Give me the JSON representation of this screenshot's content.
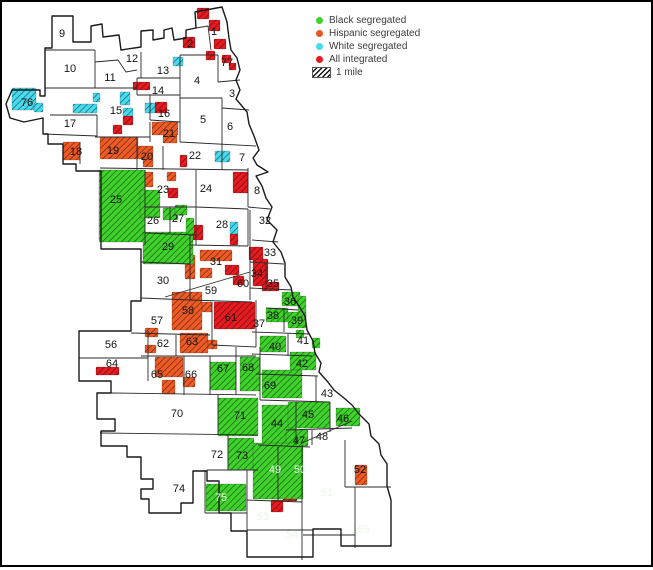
{
  "title": "Chicago community areas segregation map",
  "legend": {
    "items": [
      {
        "label": "Black segregated",
        "color": "#3ed32a",
        "swatch": "dot"
      },
      {
        "label": "Hispanic segregated",
        "color": "#ee5426",
        "swatch": "dot"
      },
      {
        "label": "White segregated",
        "color": "#45dcef",
        "swatch": "dot"
      },
      {
        "label": "All integrated",
        "color": "#e8191f",
        "swatch": "dot"
      },
      {
        "label": "1 mile",
        "color": "#111111",
        "swatch": "hatch"
      }
    ]
  },
  "map": {
    "colors": {
      "green": "#3ed32a",
      "orange": "#f15a24",
      "cyan": "#45dcef",
      "red": "#e8191f",
      "darkred": "#9e1115",
      "white": "#ffffff",
      "boundary": "#2a2a2a"
    },
    "areas": [
      {
        "n": "1",
        "x": 214,
        "y": 31
      },
      {
        "n": "2",
        "x": 190,
        "y": 43
      },
      {
        "n": "3",
        "x": 232,
        "y": 93
      },
      {
        "n": "4",
        "x": 197,
        "y": 80
      },
      {
        "n": "5",
        "x": 203,
        "y": 119
      },
      {
        "n": "6",
        "x": 230,
        "y": 126
      },
      {
        "n": "7",
        "x": 242,
        "y": 157
      },
      {
        "n": "8",
        "x": 257,
        "y": 190
      },
      {
        "n": "9",
        "x": 62,
        "y": 33
      },
      {
        "n": "10",
        "x": 70,
        "y": 68
      },
      {
        "n": "11",
        "x": 110,
        "y": 77
      },
      {
        "n": "12",
        "x": 132,
        "y": 58
      },
      {
        "n": "13",
        "x": 163,
        "y": 70
      },
      {
        "n": "14",
        "x": 158,
        "y": 90
      },
      {
        "n": "15",
        "x": 116,
        "y": 110
      },
      {
        "n": "16",
        "x": 164,
        "y": 113
      },
      {
        "n": "17",
        "x": 70,
        "y": 123
      },
      {
        "n": "18",
        "x": 76,
        "y": 151
      },
      {
        "n": "19",
        "x": 113,
        "y": 150
      },
      {
        "n": "20",
        "x": 147,
        "y": 156
      },
      {
        "n": "21",
        "x": 169,
        "y": 133
      },
      {
        "n": "22",
        "x": 195,
        "y": 155
      },
      {
        "n": "23",
        "x": 163,
        "y": 189
      },
      {
        "n": "24",
        "x": 206,
        "y": 188
      },
      {
        "n": "25",
        "x": 116,
        "y": 199
      },
      {
        "n": "26",
        "x": 153,
        "y": 220
      },
      {
        "n": "27",
        "x": 178,
        "y": 218
      },
      {
        "n": "28",
        "x": 222,
        "y": 224
      },
      {
        "n": "29",
        "x": 168,
        "y": 246
      },
      {
        "n": "30",
        "x": 163,
        "y": 280
      },
      {
        "n": "31",
        "x": 216,
        "y": 261
      },
      {
        "n": "32",
        "x": 265,
        "y": 220
      },
      {
        "n": "33",
        "x": 270,
        "y": 252
      },
      {
        "n": "34",
        "x": 257,
        "y": 273
      },
      {
        "n": "35",
        "x": 273,
        "y": 283
      },
      {
        "n": "36",
        "x": 290,
        "y": 301
      },
      {
        "n": "37",
        "x": 259,
        "y": 323
      },
      {
        "n": "38",
        "x": 273,
        "y": 315
      },
      {
        "n": "39",
        "x": 297,
        "y": 320
      },
      {
        "n": "40",
        "x": 275,
        "y": 346
      },
      {
        "n": "41",
        "x": 303,
        "y": 340
      },
      {
        "n": "42",
        "x": 302,
        "y": 363
      },
      {
        "n": "43",
        "x": 327,
        "y": 393
      },
      {
        "n": "44",
        "x": 277,
        "y": 423
      },
      {
        "n": "45",
        "x": 308,
        "y": 414
      },
      {
        "n": "46",
        "x": 343,
        "y": 418
      },
      {
        "n": "47",
        "x": 299,
        "y": 440
      },
      {
        "n": "48",
        "x": 322,
        "y": 436
      },
      {
        "n": "49",
        "x": 275,
        "y": 469,
        "light": true
      },
      {
        "n": "50",
        "x": 300,
        "y": 469,
        "light": true
      },
      {
        "n": "51",
        "x": 327,
        "y": 492,
        "light": true
      },
      {
        "n": "52",
        "x": 360,
        "y": 469
      },
      {
        "n": "53",
        "x": 263,
        "y": 516,
        "light": true
      },
      {
        "n": "54",
        "x": 292,
        "y": 534,
        "light": true
      },
      {
        "n": "55",
        "x": 364,
        "y": 529,
        "light": true
      },
      {
        "n": "56",
        "x": 111,
        "y": 344
      },
      {
        "n": "57",
        "x": 157,
        "y": 320
      },
      {
        "n": "58",
        "x": 188,
        "y": 310
      },
      {
        "n": "59",
        "x": 211,
        "y": 290
      },
      {
        "n": "60",
        "x": 243,
        "y": 283
      },
      {
        "n": "61",
        "x": 231,
        "y": 317
      },
      {
        "n": "62",
        "x": 163,
        "y": 343
      },
      {
        "n": "63",
        "x": 192,
        "y": 341
      },
      {
        "n": "64",
        "x": 112,
        "y": 363
      },
      {
        "n": "65",
        "x": 157,
        "y": 374
      },
      {
        "n": "66",
        "x": 191,
        "y": 374
      },
      {
        "n": "67",
        "x": 223,
        "y": 368
      },
      {
        "n": "68",
        "x": 248,
        "y": 367
      },
      {
        "n": "69",
        "x": 270,
        "y": 385
      },
      {
        "n": "70",
        "x": 177,
        "y": 413
      },
      {
        "n": "71",
        "x": 240,
        "y": 415
      },
      {
        "n": "72",
        "x": 217,
        "y": 454
      },
      {
        "n": "73",
        "x": 242,
        "y": 455
      },
      {
        "n": "74",
        "x": 179,
        "y": 488
      },
      {
        "n": "75",
        "x": 221,
        "y": 497,
        "light": true
      },
      {
        "n": "76",
        "x": 27,
        "y": 102
      },
      {
        "n": "77",
        "x": 227,
        "y": 62
      }
    ],
    "patches": [
      {
        "x": 197,
        "y": 8,
        "w": 12,
        "h": 11,
        "c": "red"
      },
      {
        "x": 209,
        "y": 20,
        "w": 11,
        "h": 11,
        "c": "red"
      },
      {
        "x": 183,
        "y": 37,
        "w": 12,
        "h": 11,
        "c": "red"
      },
      {
        "x": 214,
        "y": 39,
        "w": 12,
        "h": 10,
        "c": "red"
      },
      {
        "x": 206,
        "y": 51,
        "w": 9,
        "h": 9,
        "c": "red"
      },
      {
        "x": 222,
        "y": 55,
        "w": 9,
        "h": 8,
        "c": "red"
      },
      {
        "x": 229,
        "y": 63,
        "w": 7,
        "h": 7,
        "c": "red"
      },
      {
        "x": 133,
        "y": 82,
        "w": 17,
        "h": 8,
        "c": "red"
      },
      {
        "x": 155,
        "y": 102,
        "w": 12,
        "h": 11,
        "c": "red"
      },
      {
        "x": 123,
        "y": 116,
        "w": 10,
        "h": 9,
        "c": "red"
      },
      {
        "x": 113,
        "y": 125,
        "w": 9,
        "h": 9,
        "c": "red"
      },
      {
        "x": 180,
        "y": 155,
        "w": 7,
        "h": 12,
        "c": "red"
      },
      {
        "x": 168,
        "y": 188,
        "w": 10,
        "h": 10,
        "c": "red"
      },
      {
        "x": 233,
        "y": 172,
        "w": 15,
        "h": 21,
        "c": "red"
      },
      {
        "x": 193,
        "y": 225,
        "w": 10,
        "h": 15,
        "c": "red"
      },
      {
        "x": 230,
        "y": 234,
        "w": 8,
        "h": 11,
        "c": "red"
      },
      {
        "x": 249,
        "y": 247,
        "w": 14,
        "h": 13,
        "c": "red"
      },
      {
        "x": 253,
        "y": 259,
        "w": 15,
        "h": 27,
        "c": "red"
      },
      {
        "x": 225,
        "y": 265,
        "w": 14,
        "h": 10,
        "c": "red"
      },
      {
        "x": 233,
        "y": 276,
        "w": 11,
        "h": 9,
        "c": "red"
      },
      {
        "x": 262,
        "y": 282,
        "w": 17,
        "h": 9,
        "c": "red"
      },
      {
        "x": 214,
        "y": 302,
        "w": 41,
        "h": 27,
        "c": "red"
      },
      {
        "x": 296,
        "y": 357,
        "w": 7,
        "h": 8,
        "c": "red"
      },
      {
        "x": 96,
        "y": 367,
        "w": 23,
        "h": 8,
        "c": "red"
      },
      {
        "x": 283,
        "y": 487,
        "w": 14,
        "h": 14,
        "c": "red"
      },
      {
        "x": 271,
        "y": 500,
        "w": 12,
        "h": 12,
        "c": "red"
      },
      {
        "x": 12,
        "y": 88,
        "w": 24,
        "h": 22,
        "c": "cyan"
      },
      {
        "x": 34,
        "y": 103,
        "w": 9,
        "h": 9,
        "c": "cyan"
      },
      {
        "x": 153,
        "y": 50,
        "w": 20,
        "h": true,
        "c": "cyan"
      },
      {
        "x": 173,
        "y": 57,
        "w": 10,
        "h": 9,
        "c": "cyan"
      },
      {
        "x": 120,
        "y": 92,
        "w": 10,
        "h": 13,
        "c": "cyan"
      },
      {
        "x": 93,
        "y": 93,
        "w": 7,
        "h": 9,
        "c": "cyan"
      },
      {
        "x": 123,
        "y": 108,
        "w": 10,
        "h": 8,
        "c": "cyan"
      },
      {
        "x": 145,
        "y": 103,
        "w": 10,
        "h": 10,
        "c": "cyan"
      },
      {
        "x": 73,
        "y": 104,
        "w": 24,
        "h": 9,
        "c": "cyan"
      },
      {
        "x": 215,
        "y": 151,
        "w": 15,
        "h": 11,
        "c": "cyan"
      },
      {
        "x": 230,
        "y": 222,
        "w": 8,
        "h": 12,
        "c": "cyan"
      },
      {
        "x": 63,
        "y": 142,
        "w": 17,
        "h": 18,
        "c": "orange"
      },
      {
        "x": 100,
        "y": 137,
        "w": 38,
        "h": 22,
        "c": "orange"
      },
      {
        "x": 138,
        "y": 146,
        "w": 15,
        "h": 13,
        "c": "orange"
      },
      {
        "x": 152,
        "y": 122,
        "w": 26,
        "h": 13,
        "c": "orange"
      },
      {
        "x": 163,
        "y": 135,
        "w": 14,
        "h": 8,
        "c": "orange"
      },
      {
        "x": 143,
        "y": 158,
        "w": 10,
        "h": 9,
        "c": "orange"
      },
      {
        "x": 140,
        "y": 172,
        "w": 13,
        "h": 15,
        "c": "orange"
      },
      {
        "x": 167,
        "y": 172,
        "w": 9,
        "h": 9,
        "c": "orange"
      },
      {
        "x": 200,
        "y": 250,
        "w": 32,
        "h": 11,
        "c": "orange"
      },
      {
        "x": 185,
        "y": 255,
        "w": 10,
        "h": 24,
        "c": "orange"
      },
      {
        "x": 200,
        "y": 268,
        "w": 12,
        "h": 10,
        "c": "orange"
      },
      {
        "x": 172,
        "y": 292,
        "w": 30,
        "h": 38,
        "c": "orange"
      },
      {
        "x": 202,
        "y": 302,
        "w": 10,
        "h": 10,
        "c": "orange"
      },
      {
        "x": 145,
        "y": 328,
        "w": 13,
        "h": 9,
        "c": "orange"
      },
      {
        "x": 145,
        "y": 345,
        "w": 11,
        "h": 8,
        "c": "orange"
      },
      {
        "x": 180,
        "y": 333,
        "w": 28,
        "h": 20,
        "c": "orange"
      },
      {
        "x": 208,
        "y": 340,
        "w": 9,
        "h": 9,
        "c": "orange"
      },
      {
        "x": 155,
        "y": 357,
        "w": 28,
        "h": 20,
        "c": "orange"
      },
      {
        "x": 183,
        "y": 377,
        "w": 12,
        "h": 10,
        "c": "orange"
      },
      {
        "x": 162,
        "y": 380,
        "w": 13,
        "h": 14,
        "c": "orange"
      },
      {
        "x": 355,
        "y": 465,
        "w": 12,
        "h": 20,
        "c": "orange"
      },
      {
        "x": 343,
        "y": 447,
        "w": 26,
        "h": true,
        "c": "orange"
      },
      {
        "x": 99,
        "y": 170,
        "w": 46,
        "h": 72,
        "c": "green"
      },
      {
        "x": 108,
        "y": 226,
        "w": 20,
        "h": true,
        "c": "green"
      },
      {
        "x": 140,
        "y": 190,
        "w": 20,
        "h": 28,
        "c": "green"
      },
      {
        "x": 163,
        "y": 208,
        "w": 15,
        "h": 12,
        "c": "green"
      },
      {
        "x": 175,
        "y": 205,
        "w": 12,
        "h": 10,
        "c": "green"
      },
      {
        "x": 143,
        "y": 232,
        "w": 50,
        "h": 32,
        "c": "green"
      },
      {
        "x": 186,
        "y": 218,
        "w": 8,
        "h": 16,
        "c": "green"
      },
      {
        "x": 127,
        "y": 315,
        "w": 13,
        "h": true,
        "c": "green"
      },
      {
        "x": 244,
        "y": 300,
        "w": 11,
        "h": true,
        "c": "green"
      },
      {
        "x": 282,
        "y": 292,
        "w": 18,
        "h": 14,
        "c": "green"
      },
      {
        "x": 266,
        "y": 308,
        "w": 22,
        "h": 14,
        "c": "green"
      },
      {
        "x": 288,
        "y": 312,
        "w": 18,
        "h": 16,
        "c": "green"
      },
      {
        "x": 298,
        "y": 296,
        "w": 8,
        "h": 30,
        "c": "green"
      },
      {
        "x": 260,
        "y": 336,
        "w": 26,
        "h": 16,
        "c": "green"
      },
      {
        "x": 296,
        "y": 330,
        "w": 8,
        "h": 8,
        "c": "green"
      },
      {
        "x": 312,
        "y": 338,
        "w": 8,
        "h": 10,
        "c": "green"
      },
      {
        "x": 290,
        "y": 352,
        "w": 26,
        "h": 18,
        "c": "green"
      },
      {
        "x": 210,
        "y": 362,
        "w": 26,
        "h": 28,
        "c": "green"
      },
      {
        "x": 216,
        "y": 354,
        "w": 12,
        "h": true,
        "c": "green"
      },
      {
        "x": 240,
        "y": 357,
        "w": 20,
        "h": 34,
        "c": "green"
      },
      {
        "x": 262,
        "y": 370,
        "w": 40,
        "h": 28,
        "c": "green"
      },
      {
        "x": 272,
        "y": 376,
        "w": 28,
        "h": true,
        "c": "green"
      },
      {
        "x": 316,
        "y": 384,
        "w": 30,
        "h": true,
        "c": "green"
      },
      {
        "x": 218,
        "y": 398,
        "w": 40,
        "h": 38,
        "c": "green"
      },
      {
        "x": 234,
        "y": 420,
        "w": 16,
        "h": true,
        "c": "green"
      },
      {
        "x": 262,
        "y": 405,
        "w": 34,
        "h": 40,
        "c": "green"
      },
      {
        "x": 288,
        "y": 402,
        "w": 42,
        "h": 26,
        "c": "green"
      },
      {
        "x": 336,
        "y": 408,
        "w": 24,
        "h": 18,
        "c": "green"
      },
      {
        "x": 350,
        "y": 422,
        "w": 12,
        "h": true,
        "c": "green"
      },
      {
        "x": 286,
        "y": 430,
        "w": 22,
        "h": 16,
        "c": "green"
      },
      {
        "x": 292,
        "y": 432,
        "w": 12,
        "h": true,
        "c": "green"
      },
      {
        "x": 228,
        "y": 438,
        "w": 26,
        "h": 32,
        "c": "green"
      },
      {
        "x": 253,
        "y": 443,
        "w": 50,
        "h": 56,
        "c": "green"
      },
      {
        "x": 303,
        "y": 443,
        "w": 57,
        "h": true,
        "c": "green"
      },
      {
        "x": 246,
        "y": 502,
        "w": 38,
        "h": true,
        "c": "green"
      },
      {
        "x": 255,
        "y": 520,
        "w": 52,
        "h": true,
        "c": "green"
      },
      {
        "x": 206,
        "y": 484,
        "w": 40,
        "h": 27,
        "c": "green"
      },
      {
        "x": 228,
        "y": 488,
        "w": 18,
        "h": true,
        "c": "green"
      },
      {
        "x": 355,
        "y": 487,
        "w": 36,
        "h": true,
        "c": "darkred"
      },
      {
        "x": 363,
        "y": 438,
        "w": 15,
        "h": true,
        "c": "white"
      },
      {
        "x": 254,
        "y": 530,
        "w": 12,
        "h": true,
        "c": "white"
      }
    ]
  }
}
